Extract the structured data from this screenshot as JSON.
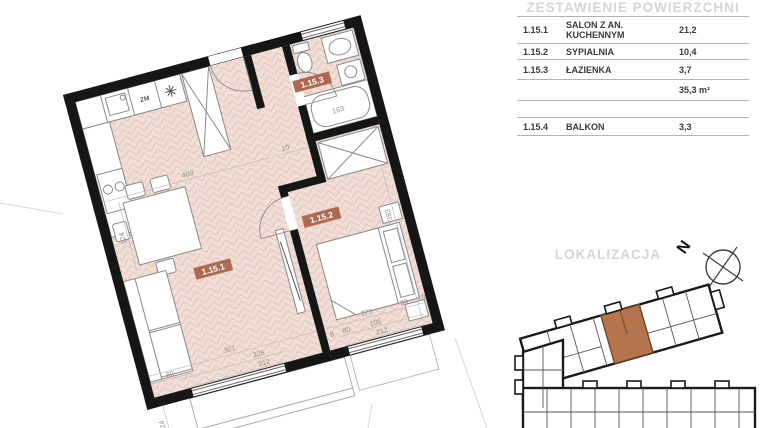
{
  "table": {
    "title": "ZESTAWIENIE POWIERZCHNI",
    "rows": [
      {
        "code": "1.15.1",
        "name": "SALON Z AN. KUCHENNYM",
        "area": "21,2"
      },
      {
        "code": "1.15.2",
        "name": "SYPIALNIA",
        "area": "10,4"
      },
      {
        "code": "1.15.3",
        "name": "ŁAZIENKA",
        "area": "3,7"
      }
    ],
    "total": "35,3 m²",
    "extra": [
      {
        "code": "1.15.4",
        "name": "BALKON",
        "area": "3,3"
      }
    ]
  },
  "localization": {
    "title": "LOKALIZACJA",
    "compass_label": "N"
  },
  "plan": {
    "room_labels": [
      {
        "id": "1.15.1"
      },
      {
        "id": "1.15.2"
      },
      {
        "id": "1.15.3"
      }
    ],
    "fixtures": {
      "dishwasher_label": "ZM"
    },
    "dims": [
      "409",
      "10",
      "124",
      "80",
      "301",
      "205",
      "212",
      "8",
      "80",
      "273",
      "89",
      "18",
      "105",
      "212",
      "383",
      "24",
      "163"
    ],
    "colors": {
      "floor": "#f1ded6",
      "floor_line": "#e3c7ba",
      "wall": "#161616",
      "room_label_bg": "#ae6a50",
      "furniture": "#8a8a8a",
      "dim_text": "#8f8f8f",
      "locator_highlight": "#b4744e",
      "muted_header": "#d5d5d5"
    }
  }
}
